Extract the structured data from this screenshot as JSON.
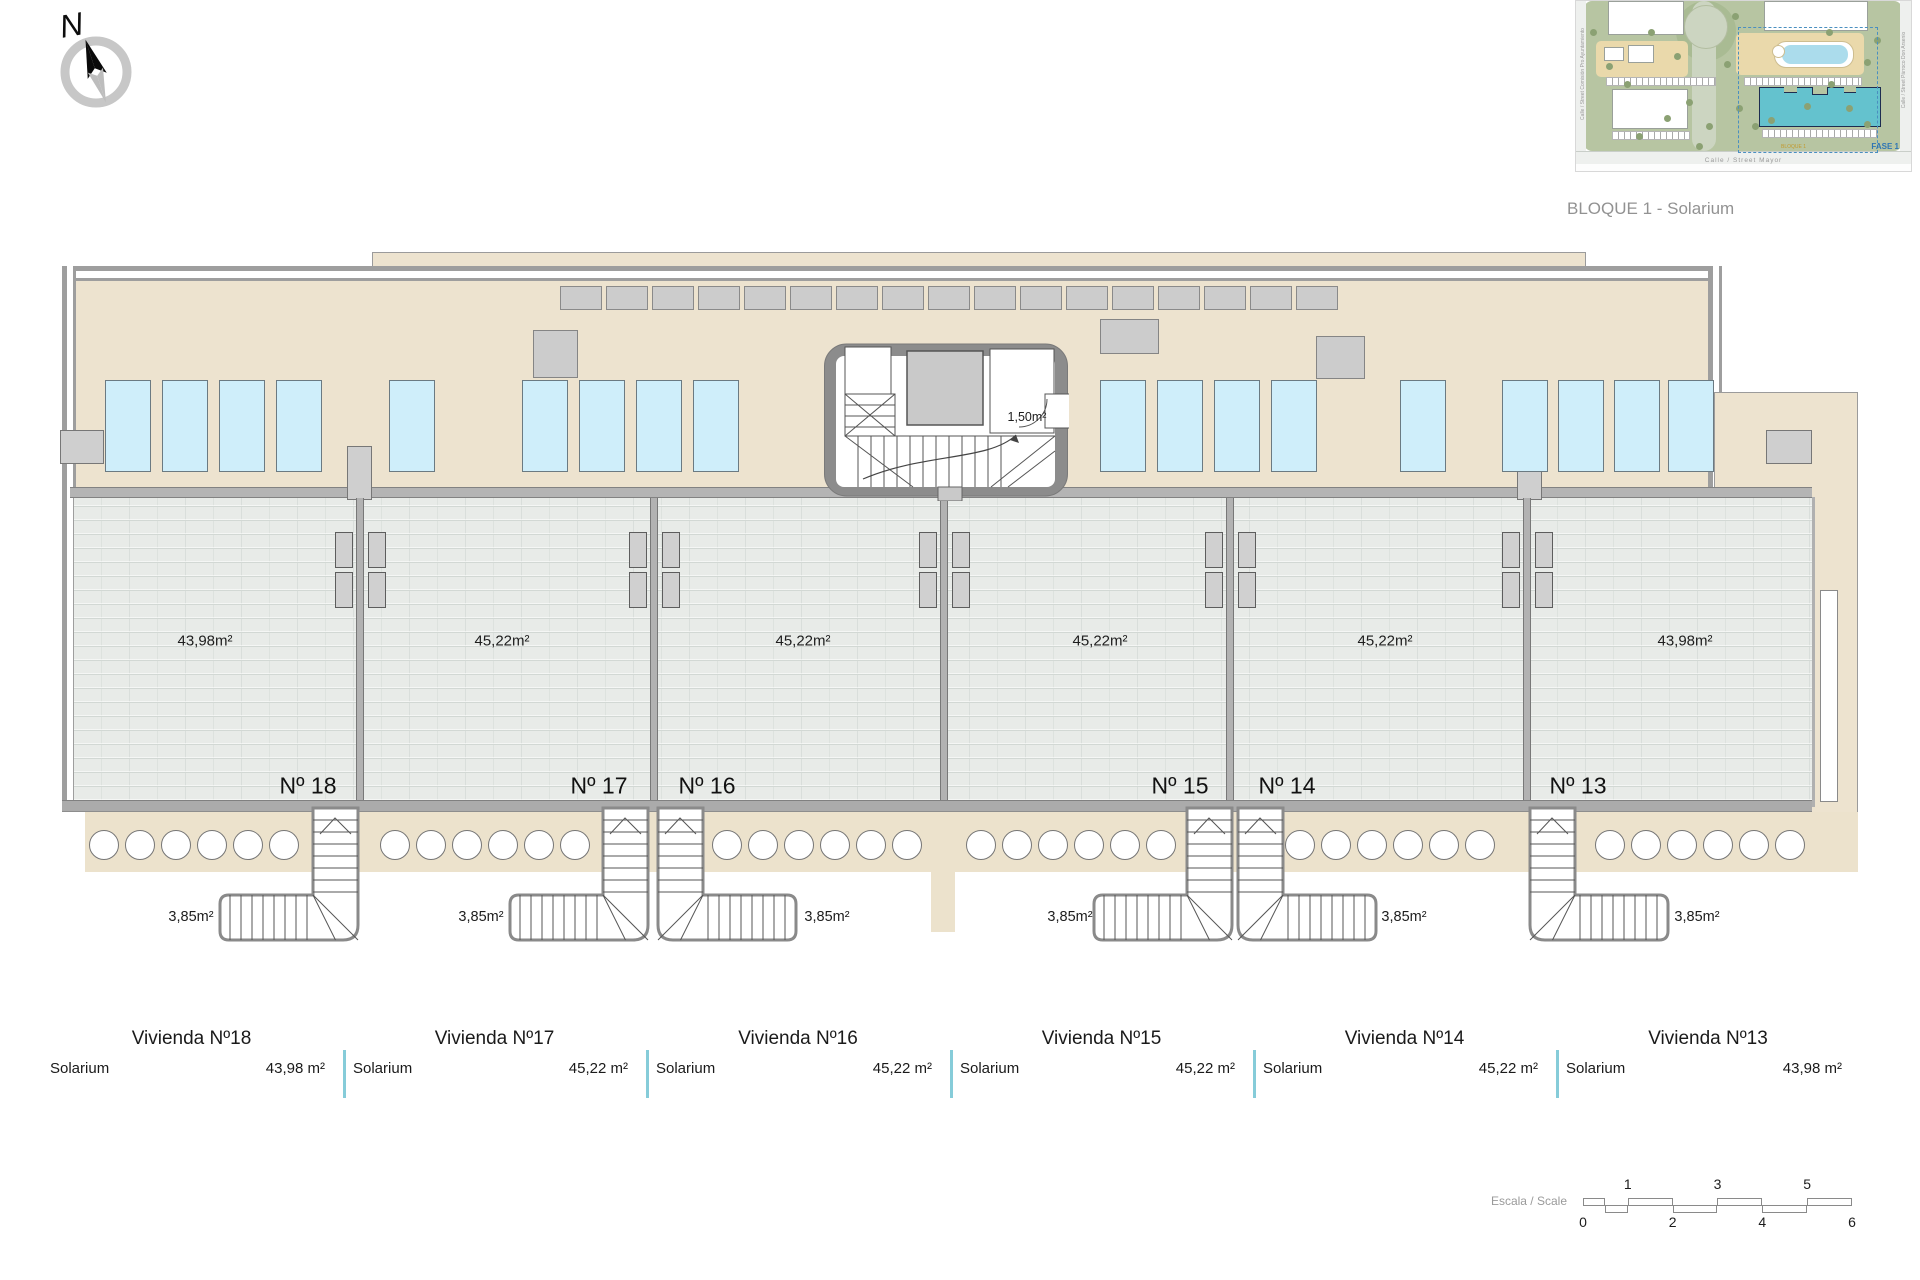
{
  "header": {
    "caption": "BLOQUE 1 - Solarium",
    "compass_letter": "N"
  },
  "site_plan": {
    "street_bottom": "Calle / Street Mayor",
    "street_left": "Calle / Street Comisión Pro Ayuntamiento",
    "street_right": "Calle / Street Párroco Don Arsenio",
    "phase_label": "FASE 1",
    "block_label": "BLOQUE 1"
  },
  "plan": {
    "stairwell_area_label": "1,50m²",
    "units": [
      {
        "id": "18",
        "number_label": "Nº 18",
        "area_label": "43,98m²",
        "stair_label": "3,85m²"
      },
      {
        "id": "17",
        "number_label": "Nº 17",
        "area_label": "45,22m²",
        "stair_label": "3,85m²"
      },
      {
        "id": "16",
        "number_label": "Nº 16",
        "area_label": "45,22m²",
        "stair_label": "3,85m²"
      },
      {
        "id": "15",
        "number_label": "Nº 15",
        "area_label": "45,22m²",
        "stair_label": "3,85m²"
      },
      {
        "id": "14",
        "number_label": "Nº 14",
        "area_label": "45,22m²",
        "stair_label": "3,85m²"
      },
      {
        "id": "13",
        "number_label": "Nº 13",
        "area_label": "43,98m²",
        "stair_label": "3,85m²"
      }
    ]
  },
  "legend": {
    "items": [
      {
        "title": "Vivienda Nº18",
        "room": "Solarium",
        "area": "43,98 m²"
      },
      {
        "title": "Vivienda Nº17",
        "room": "Solarium",
        "area": "45,22 m²"
      },
      {
        "title": "Vivienda Nº16",
        "room": "Solarium",
        "area": "45,22 m²"
      },
      {
        "title": "Vivienda Nº15",
        "room": "Solarium",
        "area": "45,22 m²"
      },
      {
        "title": "Vivienda Nº14",
        "room": "Solarium",
        "area": "45,22 m²"
      },
      {
        "title": "Vivienda Nº13",
        "room": "Solarium",
        "area": "43,98 m²"
      }
    ]
  },
  "scale_bar": {
    "label": "Escala / Scale",
    "top_numbers": [
      "1",
      "3",
      "5"
    ],
    "bottom_numbers": [
      "0",
      "2",
      "4",
      "6"
    ]
  }
}
